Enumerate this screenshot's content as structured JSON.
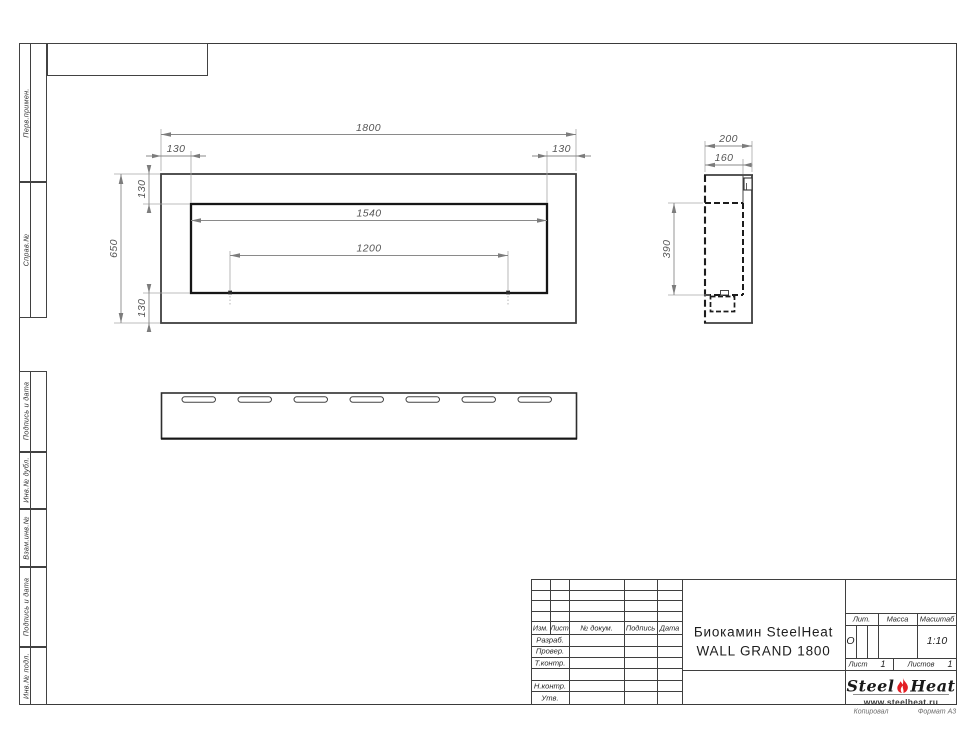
{
  "frame": {
    "side_labels_top": [
      "Перв.примен.",
      "Справ.№"
    ],
    "side_labels_bottom": [
      "Подпись и дата",
      "Инв.№ дубл.",
      "Взам.инв.№",
      "Подпись и дата",
      "Инв.№ подл."
    ],
    "copy_label": "Копировал",
    "format_label": "Формат А3"
  },
  "title_block": {
    "change_header": [
      "Изм.",
      "Лист",
      "№ докум.",
      "Подпись",
      "Дата"
    ],
    "roles": [
      "Разраб.",
      "Провер.",
      "Т.контр.",
      "Н.контр.",
      "Утв."
    ],
    "title_line1": "Биокамин SteelHeat",
    "title_line2": "WALL GRAND 1800",
    "lit_label": "Лит.",
    "lit_value": "О",
    "mass_label": "Масса",
    "scale_label": "Масштаб",
    "scale_value": "1:10",
    "sheet_label": "Лист",
    "sheet_value": "1",
    "sheets_label": "Листов",
    "sheets_value": "1",
    "logo_steel": "Steel",
    "logo_heat": "Heat",
    "logo_url": "www.steelheat.ru",
    "flame_color": "#e31e24"
  },
  "dims": {
    "front": {
      "total_width": "1800",
      "left_offset": "130",
      "right_offset": "130",
      "top_offset": "130",
      "total_height": "650",
      "bottom_offset": "130",
      "opening_width": "1540",
      "burner_span": "1200"
    },
    "side": {
      "depth": "200",
      "inner_depth": "160",
      "opening_height": "390"
    }
  }
}
